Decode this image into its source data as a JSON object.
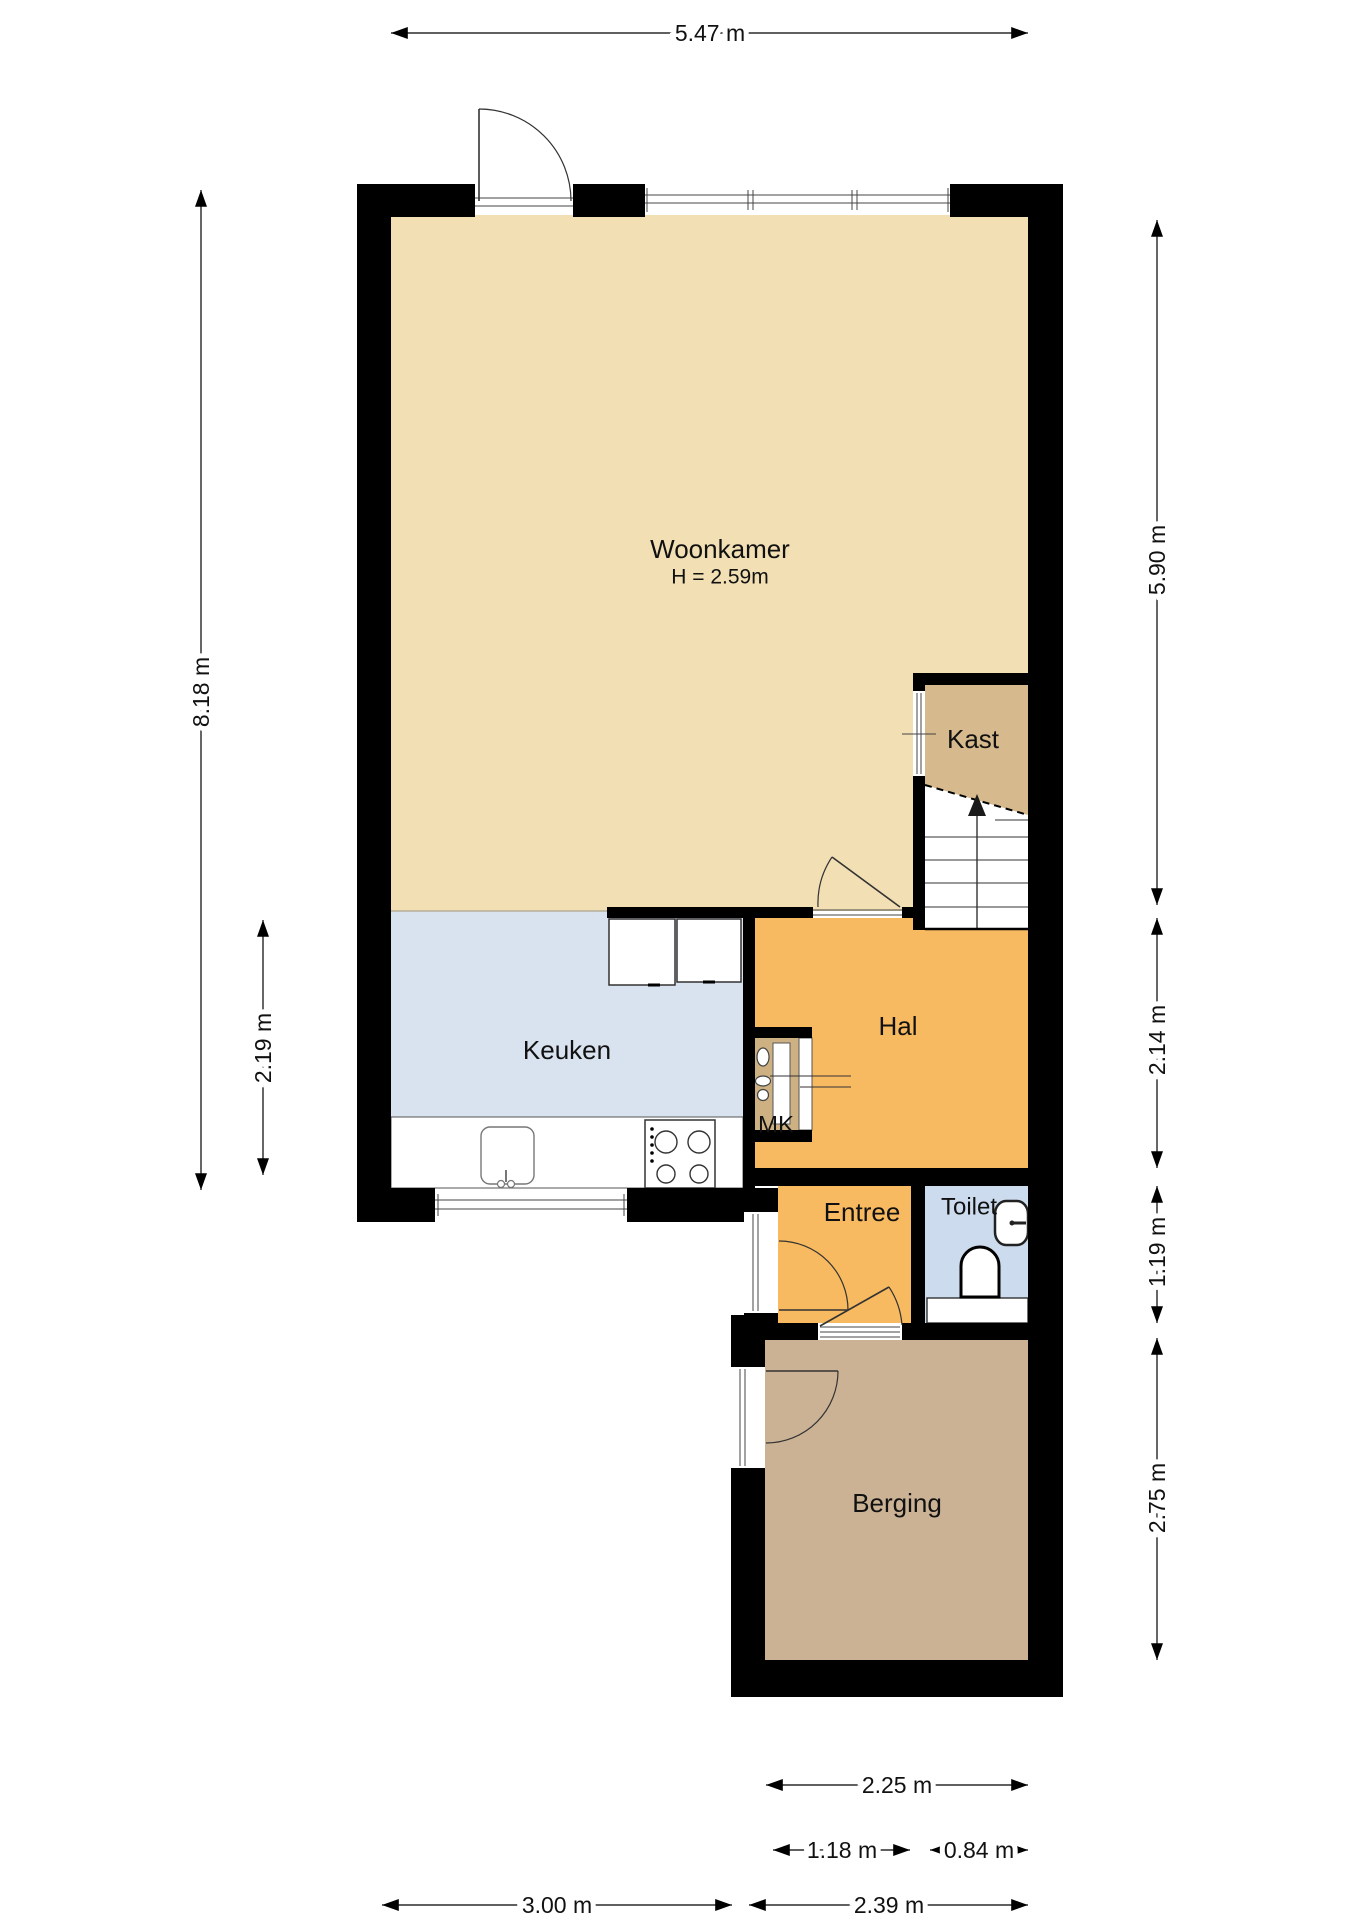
{
  "rooms": {
    "woonkamer": {
      "label": "Woonkamer",
      "height_note": "H = 2.59m"
    },
    "kast": {
      "label": "Kast"
    },
    "keuken": {
      "label": "Keuken"
    },
    "hal": {
      "label": "Hal"
    },
    "mk": {
      "label": "MK"
    },
    "entree": {
      "label": "Entree"
    },
    "toilet": {
      "label": "Toilet"
    },
    "berging": {
      "label": "Berging"
    }
  },
  "dimensions": {
    "top_width": "5.47 m",
    "left_total": "8.18 m",
    "left_keuken": "2.19 m",
    "right_woonkamer": "5.90 m",
    "right_hal": "2.14 m",
    "right_toilet": "1.19 m",
    "right_berging": "2.75 m",
    "bottom_berging": "2.25 m",
    "bottom_frontdoor": "1.18 m",
    "bottom_toilet": "0.84 m",
    "bottom_keuken": "3.00 m",
    "bottom_entree": "2.39 m"
  },
  "palette": {
    "woonkamer": "#f2dfb4",
    "keuken": "#d9e2ef",
    "hal": "#f8ba60",
    "entree": "#f8ba60",
    "kast": "#d6b98c",
    "mk": "#cdb183",
    "toilet": "#ccdbed",
    "berging": "#cbb295",
    "wall": "#000000",
    "background": "#ffffff"
  }
}
